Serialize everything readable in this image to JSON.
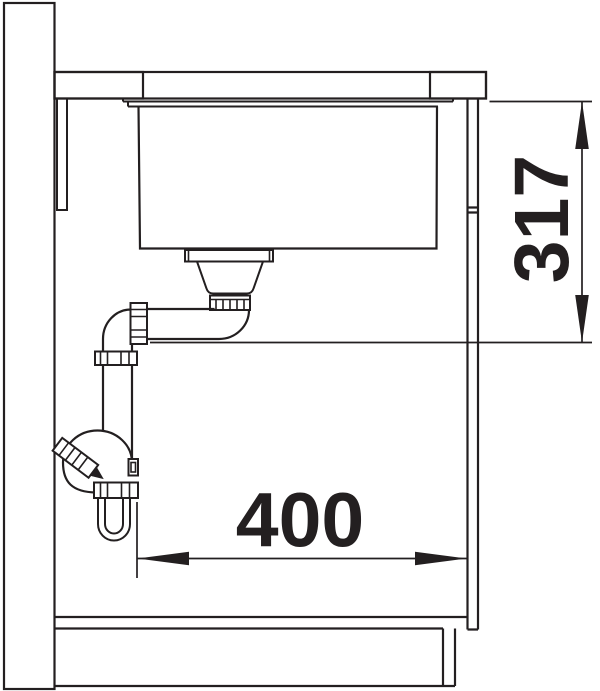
{
  "diagram": {
    "type": "technical-drawing",
    "subject": "undermount-sink-installation-side-section",
    "colors": {
      "line": "#231f20",
      "background": "#ffffff"
    },
    "dimensions": {
      "depth": {
        "value": "317",
        "orientation": "vertical",
        "unit_shown": false
      },
      "width": {
        "value": "400",
        "orientation": "horizontal",
        "unit_shown": false
      }
    }
  }
}
